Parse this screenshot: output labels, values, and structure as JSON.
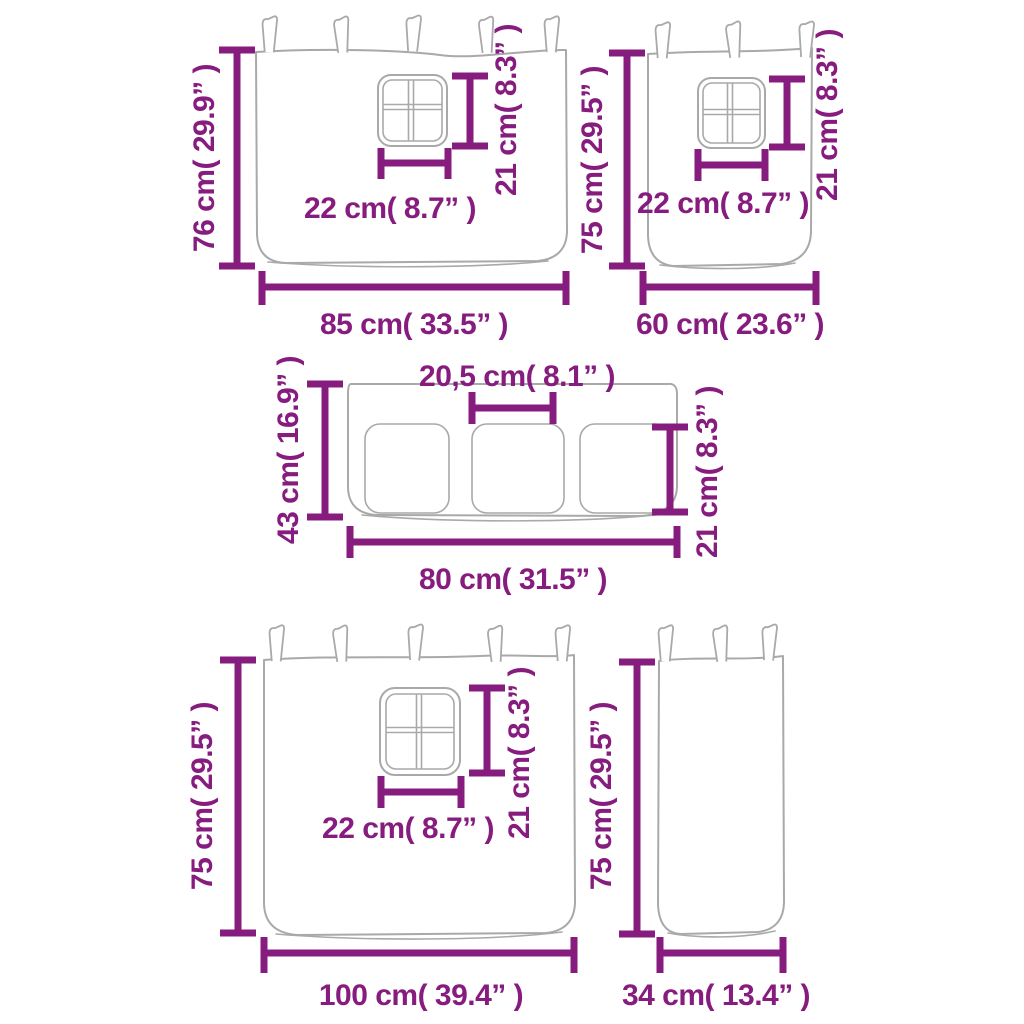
{
  "colors": {
    "dimension_accent": "#871C7F",
    "drawing_outline": "#A9A9A9",
    "background": "#FFFFFF"
  },
  "diagram": {
    "description_labels": {
      "unit_pattern": "cm / inches"
    },
    "panels": [
      {
        "name": "curtain-with-window-85",
        "height_label": "76 cm( 29.9” )",
        "width_label": "85 cm( 33.5” )",
        "window_width_label": "22 cm( 8.7” )",
        "window_height_label": "21 cm( 8.3” )"
      },
      {
        "name": "curtain-with-window-60",
        "height_label": "75 cm( 29.5” )",
        "width_label": "60 cm( 23.6” )",
        "window_width_label": "22 cm( 8.7” )",
        "window_height_label": "21 cm( 8.3” )"
      },
      {
        "name": "pocket-panel-80",
        "height_label": "43 cm( 16.9” )",
        "width_label": "80 cm( 31.5” )",
        "pocket_width_label": "20,5 cm( 8.1” )",
        "pocket_height_label": "21 cm( 8.3” )"
      },
      {
        "name": "curtain-with-window-100",
        "height_label": "75 cm( 29.5” )",
        "width_label": "100 cm( 39.4” )",
        "window_width_label": "22 cm( 8.7” )",
        "window_height_label": "21 cm( 8.3” )"
      },
      {
        "name": "narrow-curtain-34",
        "height_label": "75 cm( 29.5” )",
        "width_label": "34 cm( 13.4” )"
      }
    ]
  }
}
